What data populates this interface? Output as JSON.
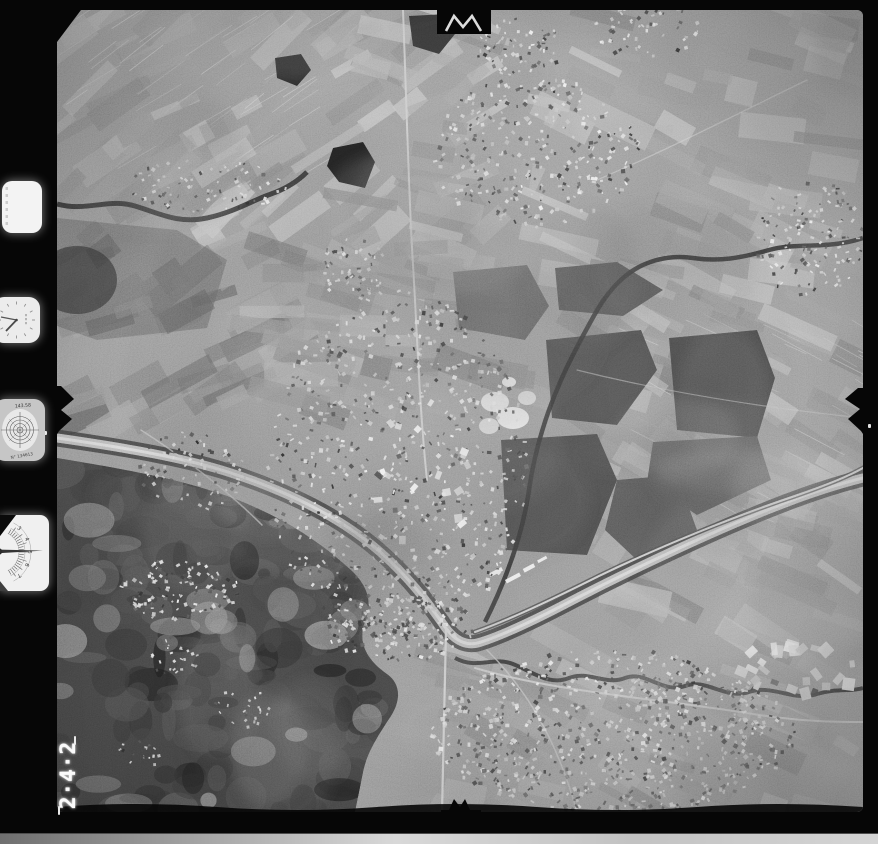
{
  "scan": {
    "frame_number": "242",
    "frame_number_display": "2·4·2",
    "instruments": {
      "collimation_target": {
        "top_text": "143.58",
        "bottom_text": "N° 134613"
      },
      "altimeter": {
        "tick_labels": [
          "3",
          "4",
          "5",
          "6",
          "7"
        ]
      }
    },
    "palette": {
      "film_border": "#060606",
      "photo_base": "#8a8a8a",
      "scan_bed": "#cfcfcf",
      "dial_face": "#f1f1f1",
      "pond": "#474747",
      "river": "#b0b0b0",
      "urban_light": "#e0e0e0",
      "woods_dark": "#3c3c3c"
    }
  }
}
